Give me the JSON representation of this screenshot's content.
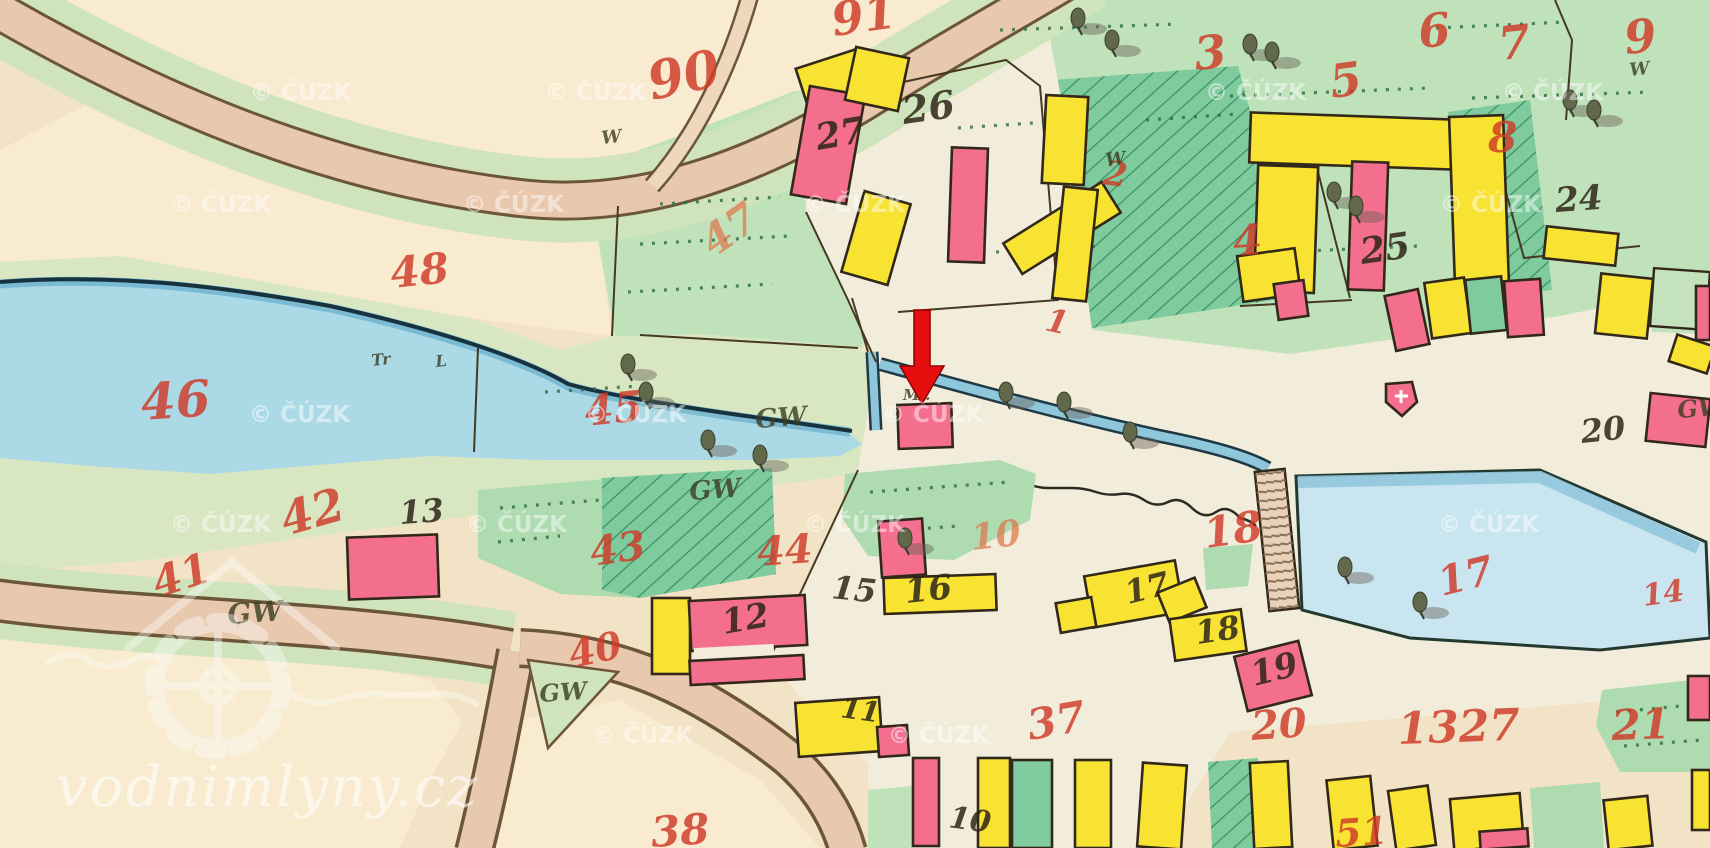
{
  "map": {
    "description": "historic hand-drawn cadastral map sheet",
    "watermarks": {
      "site": "vodnimlyny.cz",
      "cuzk": "© ČÚZK",
      "cuzk_positions": [
        [
          250,
          100
        ],
        [
          545,
          100
        ],
        [
          1205,
          100
        ],
        [
          1502,
          100
        ],
        [
          170,
          212
        ],
        [
          463,
          212
        ],
        [
          804,
          212
        ],
        [
          1440,
          212
        ],
        [
          249,
          422
        ],
        [
          585,
          422
        ],
        [
          882,
          422
        ],
        [
          170,
          532
        ],
        [
          466,
          532
        ],
        [
          804,
          532
        ],
        [
          1438,
          532
        ],
        [
          592,
          743
        ],
        [
          888,
          743
        ]
      ]
    },
    "colors": {
      "paper": "#f3e3c6",
      "village": "#f2edda",
      "meadow": "#d8e7c2",
      "garden": "#aedbb0",
      "gardenDark": "#7fcb9e",
      "water": "#abd9e6",
      "pond": "#c9e5f0",
      "road": "#e9c9ae",
      "roadEdge": "#6b5738",
      "pink": "#f46e8e",
      "yellow": "#f8e232",
      "red": "#cf3a28",
      "redFaded": "#dd7b4e",
      "ink": "#2e2617",
      "arrow": "#e60f0f"
    },
    "red_parcel_labels": [
      {
        "t": "90",
        "x": 652,
        "y": 100,
        "s": 52,
        "r": -12
      },
      {
        "t": "91",
        "x": 834,
        "y": 36,
        "s": 46,
        "r": -8
      },
      {
        "t": "47",
        "x": 714,
        "y": 258,
        "s": 42,
        "r": -35,
        "f": 1
      },
      {
        "t": "48",
        "x": 392,
        "y": 288,
        "s": 42,
        "r": -6
      },
      {
        "t": "46",
        "x": 142,
        "y": 420,
        "s": 50,
        "r": -4
      },
      {
        "t": "45",
        "x": 586,
        "y": 426,
        "s": 42,
        "r": -6
      },
      {
        "t": "42",
        "x": 286,
        "y": 536,
        "s": 46,
        "r": -16
      },
      {
        "t": "41",
        "x": 158,
        "y": 598,
        "s": 42,
        "r": -18
      },
      {
        "t": "43",
        "x": 592,
        "y": 566,
        "s": 40,
        "r": -8
      },
      {
        "t": "44",
        "x": 758,
        "y": 566,
        "s": 40,
        "r": -4
      },
      {
        "t": "40",
        "x": 572,
        "y": 668,
        "s": 38,
        "r": -12
      },
      {
        "t": "3",
        "x": 1196,
        "y": 70,
        "s": 46,
        "r": -6
      },
      {
        "t": "5",
        "x": 1332,
        "y": 98,
        "s": 46,
        "r": -8
      },
      {
        "t": "6",
        "x": 1420,
        "y": 48,
        "s": 46,
        "r": -6
      },
      {
        "t": "7",
        "x": 1500,
        "y": 60,
        "s": 46,
        "r": -6
      },
      {
        "t": "9",
        "x": 1626,
        "y": 54,
        "s": 46,
        "r": -6
      },
      {
        "t": "8",
        "x": 1488,
        "y": 152,
        "s": 42,
        "r": 0
      },
      {
        "t": "4",
        "x": 1234,
        "y": 256,
        "s": 42,
        "r": -4
      },
      {
        "t": "2",
        "x": 1102,
        "y": 184,
        "s": 34,
        "r": 8
      },
      {
        "t": "1",
        "x": 1044,
        "y": 330,
        "s": 32,
        "r": 12
      },
      {
        "t": "10",
        "x": 972,
        "y": 550,
        "s": 36,
        "r": -6,
        "f": 1
      },
      {
        "t": "18",
        "x": 1206,
        "y": 548,
        "s": 42,
        "r": -8
      },
      {
        "t": "17",
        "x": 1442,
        "y": 596,
        "s": 40,
        "r": -14
      },
      {
        "t": "14",
        "x": 1644,
        "y": 606,
        "s": 30,
        "r": -8
      },
      {
        "t": "20",
        "x": 1252,
        "y": 740,
        "s": 40,
        "r": -4
      },
      {
        "t": "1327",
        "x": 1398,
        "y": 744,
        "s": 44,
        "r": -2
      },
      {
        "t": "21",
        "x": 1612,
        "y": 740,
        "s": 42,
        "r": -2
      },
      {
        "t": "37",
        "x": 1030,
        "y": 740,
        "s": 42,
        "r": -10
      },
      {
        "t": "38",
        "x": 652,
        "y": 847,
        "s": 42,
        "r": -4
      },
      {
        "t": "51",
        "x": 1336,
        "y": 847,
        "s": 38,
        "r": -4
      }
    ],
    "house_number_labels": [
      {
        "t": "27",
        "x": 818,
        "y": 150,
        "s": 36,
        "r": -10
      },
      {
        "t": "26",
        "x": 904,
        "y": 124,
        "s": 38,
        "r": -8
      },
      {
        "t": "25",
        "x": 1362,
        "y": 264,
        "s": 36,
        "r": -8
      },
      {
        "t": "24",
        "x": 1556,
        "y": 212,
        "s": 34,
        "r": -4
      },
      {
        "t": "13",
        "x": 400,
        "y": 524,
        "s": 32,
        "r": -4
      },
      {
        "t": "12",
        "x": 724,
        "y": 634,
        "s": 34,
        "r": -10
      },
      {
        "t": "15",
        "x": 831,
        "y": 598,
        "s": 32,
        "r": 6
      },
      {
        "t": "16",
        "x": 906,
        "y": 603,
        "s": 34,
        "r": -6
      },
      {
        "t": "17",
        "x": 1128,
        "y": 604,
        "s": 32,
        "r": -14
      },
      {
        "t": "18",
        "x": 1197,
        "y": 644,
        "s": 32,
        "r": -8
      },
      {
        "t": "19",
        "x": 1254,
        "y": 686,
        "s": 34,
        "r": -14
      },
      {
        "t": "11",
        "x": 840,
        "y": 717,
        "s": 28,
        "r": 8
      },
      {
        "t": "10",
        "x": 948,
        "y": 827,
        "s": 30,
        "r": 8
      },
      {
        "t": "20",
        "x": 1582,
        "y": 443,
        "s": 32,
        "r": -6
      }
    ],
    "landuse_labels": [
      {
        "t": "GW",
        "x": 756,
        "y": 428,
        "s": 26,
        "r": -4
      },
      {
        "t": "GW",
        "x": 690,
        "y": 500,
        "s": 26,
        "r": -4
      },
      {
        "t": "GW",
        "x": 228,
        "y": 624,
        "s": 28,
        "r": -4
      },
      {
        "t": "GW",
        "x": 540,
        "y": 702,
        "s": 24,
        "r": -4
      },
      {
        "t": "GW",
        "x": 1678,
        "y": 418,
        "s": 24,
        "r": -4
      },
      {
        "t": "Ml.",
        "x": 903,
        "y": 400,
        "s": 15,
        "r": 0
      },
      {
        "t": "Tr",
        "x": 372,
        "y": 366,
        "s": 16,
        "r": -6
      },
      {
        "t": "L",
        "x": 436,
        "y": 367,
        "s": 16,
        "r": -6
      },
      {
        "t": "W",
        "x": 602,
        "y": 144,
        "s": 18,
        "r": -6
      },
      {
        "t": "W",
        "x": 1106,
        "y": 166,
        "s": 18,
        "r": -6
      },
      {
        "t": "W",
        "x": 1630,
        "y": 76,
        "s": 18,
        "r": -6
      }
    ],
    "marker": {
      "name": "red-location-arrow",
      "points_to": "mill building",
      "color": "#e60f0f"
    }
  }
}
